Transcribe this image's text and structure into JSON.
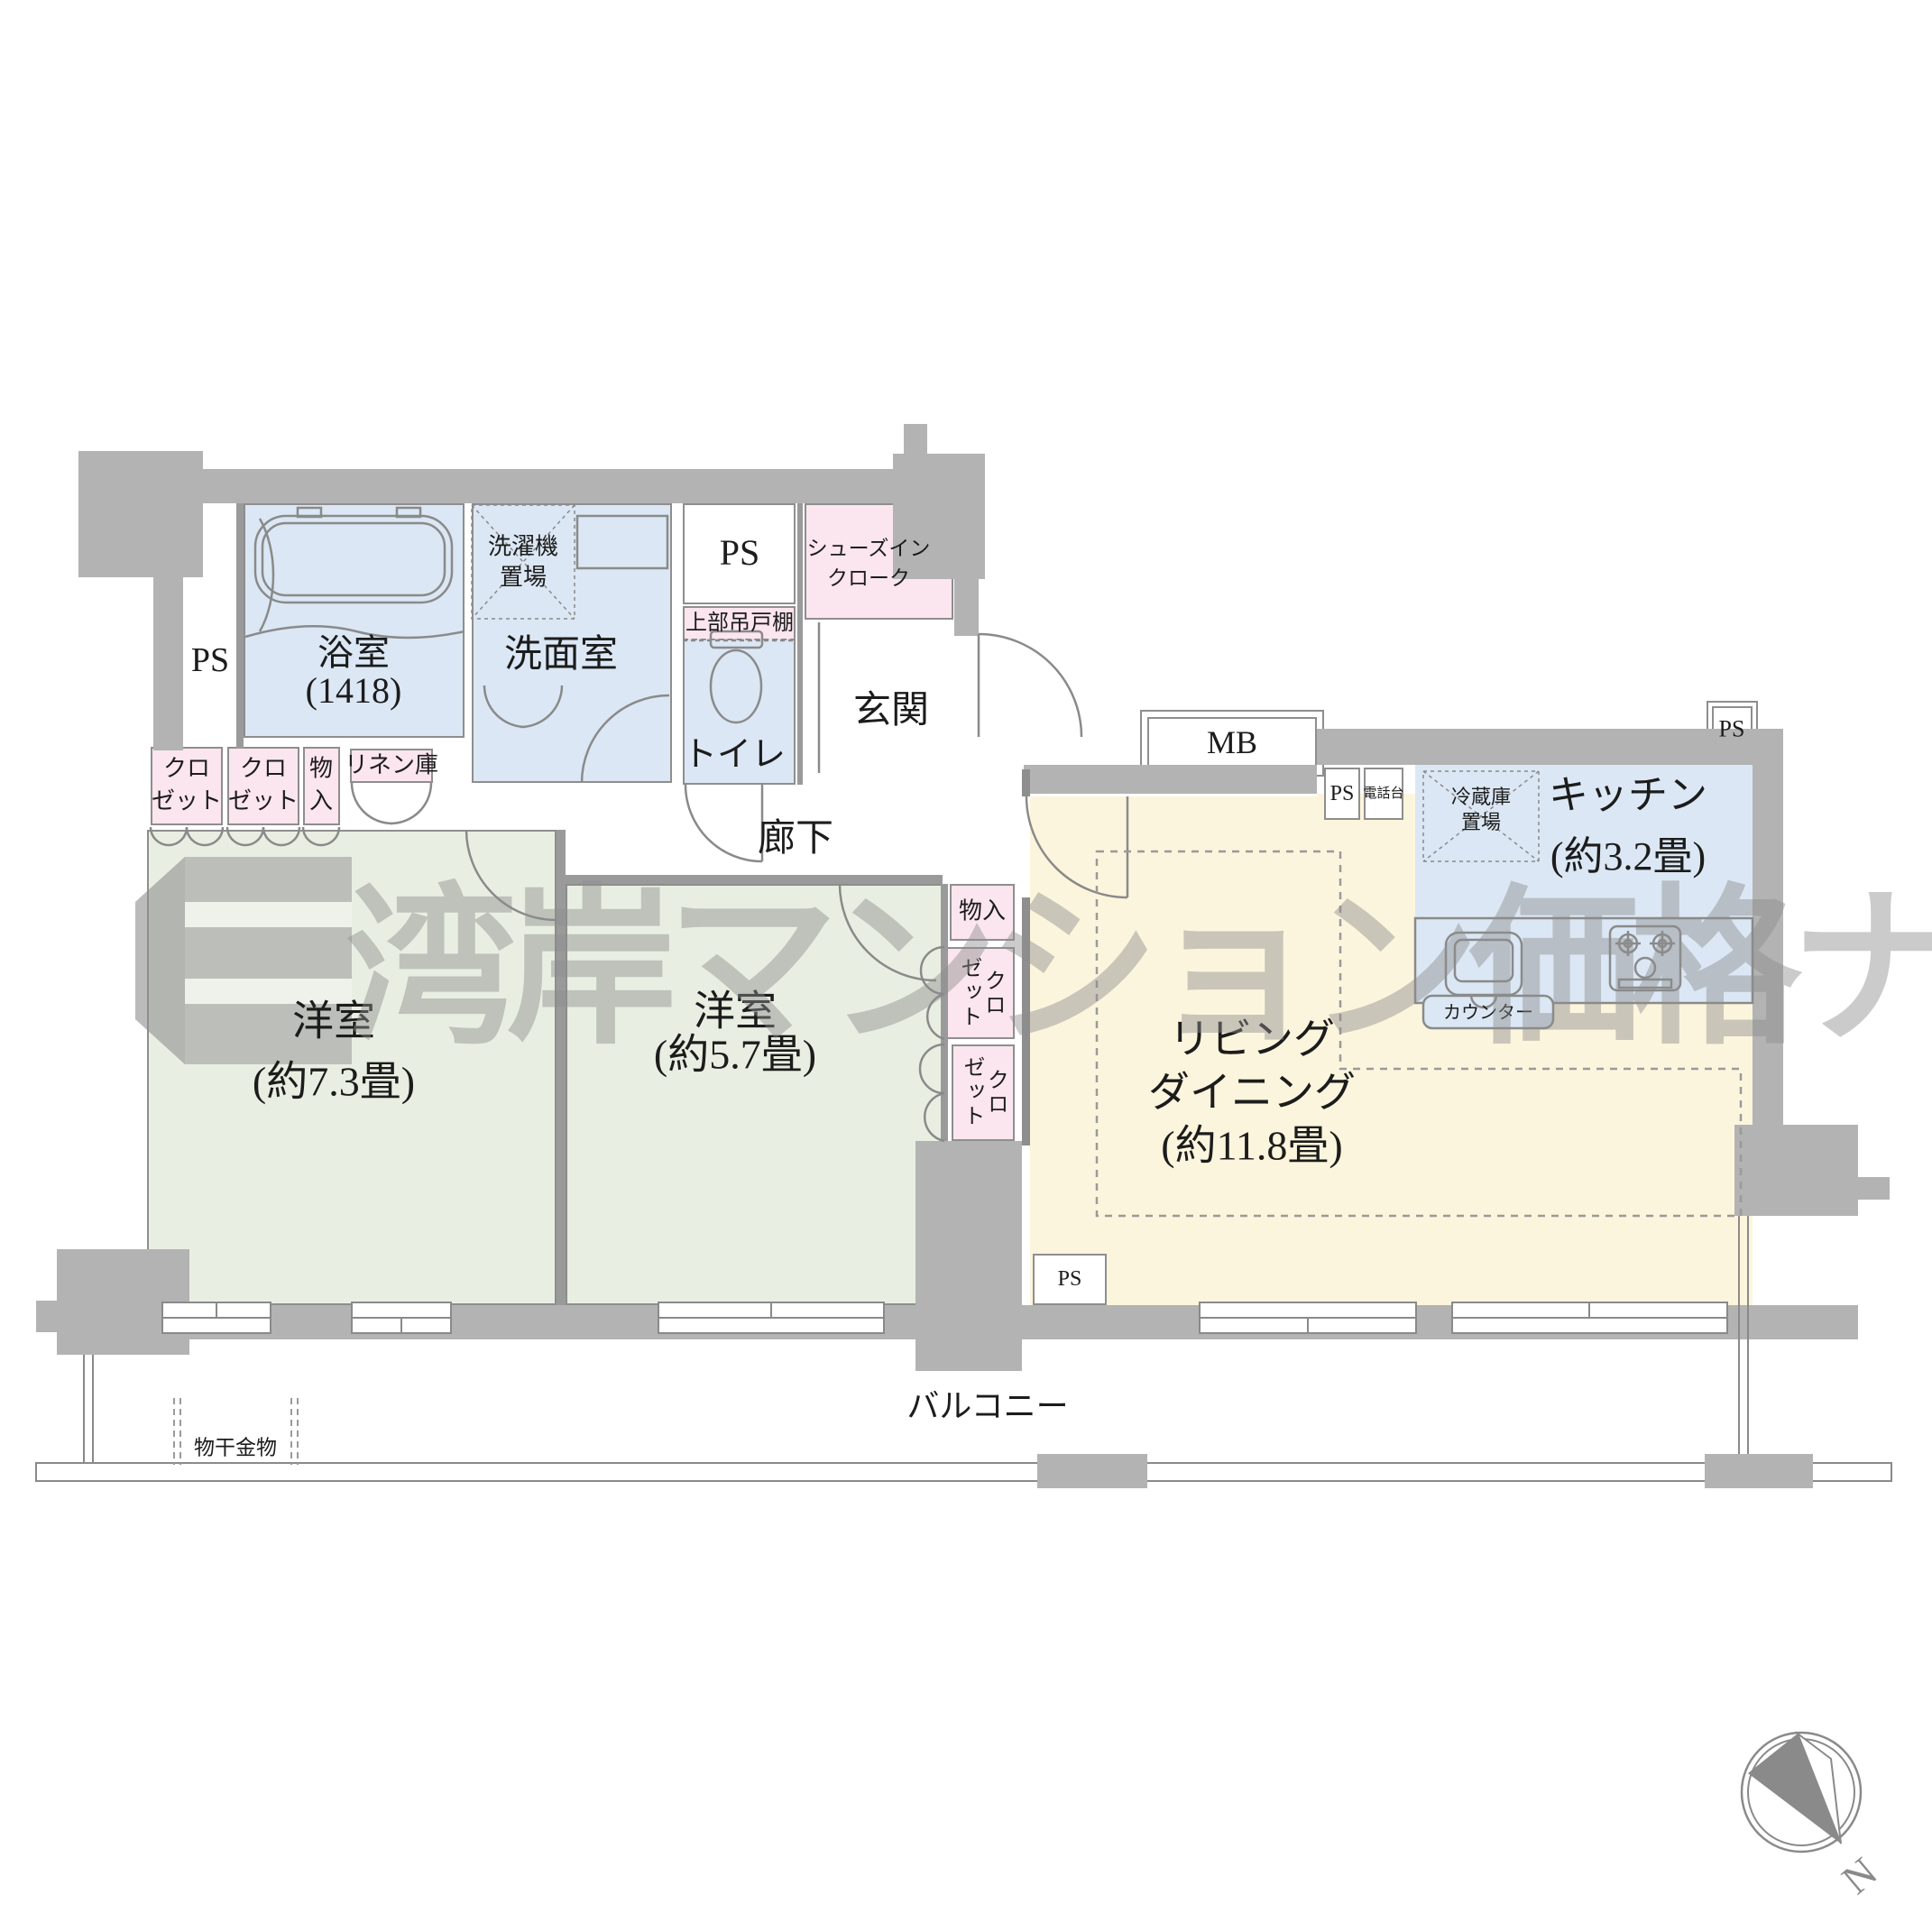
{
  "meta": {
    "type": "floorplan",
    "layout_name": "2LDK apartment floor plan"
  },
  "colors": {
    "wall": "#b3b3b3",
    "wet_area_blue": "#dbe7f4",
    "closet_pink": "#fbe5ee",
    "bedroom_green": "#e8efe2",
    "living_yellow": "#fcf5dd",
    "line_gray": "#8a8a8a",
    "watermark_gray": "#8d8d8d"
  },
  "watermark": {
    "text": "湾岸マンション価格ナビ"
  },
  "compass": {
    "north_label": "N"
  },
  "rooms": {
    "bath": {
      "name": "浴室",
      "size": "(1418)"
    },
    "washroom": {
      "name": "洗面室"
    },
    "washer": {
      "line1": "洗濯機",
      "line2": "置場"
    },
    "ps": {
      "label": "PS"
    },
    "cabinet": {
      "name": "上部吊戸棚"
    },
    "toilet": {
      "name": "トイレ"
    },
    "shoe_closet": {
      "line1": "シューズイン",
      "line2": "クローク"
    },
    "entrance": {
      "name": "玄関"
    },
    "hallway": {
      "name": "廊下"
    },
    "mb": {
      "label": "MB"
    },
    "phone": {
      "name": "電話台"
    },
    "fridge": {
      "line1": "冷蔵庫",
      "line2": "置場"
    },
    "kitchen": {
      "name": "キッチン",
      "size": "(約3.2畳)"
    },
    "counter": {
      "name": "カウンター"
    },
    "living": {
      "line1": "リビング",
      "line2": "ダイニング",
      "line3": "(約11.8畳)"
    },
    "closet": {
      "line1": "クロ",
      "line2": "ゼット"
    },
    "closet_vertical": {
      "text": "クロ\nゼット"
    },
    "storage": {
      "name": "物入"
    },
    "storage_vertical": {
      "line1": "物",
      "line2": "入"
    },
    "linen": {
      "name": "リネン庫"
    },
    "bedroom1": {
      "name": "洋室",
      "size": "(約7.3畳)"
    },
    "bedroom2": {
      "name": "洋室",
      "size": "(約5.7畳)"
    },
    "balcony": {
      "name": "バルコニー"
    },
    "laundry_hanger": {
      "name": "物干金物"
    }
  }
}
